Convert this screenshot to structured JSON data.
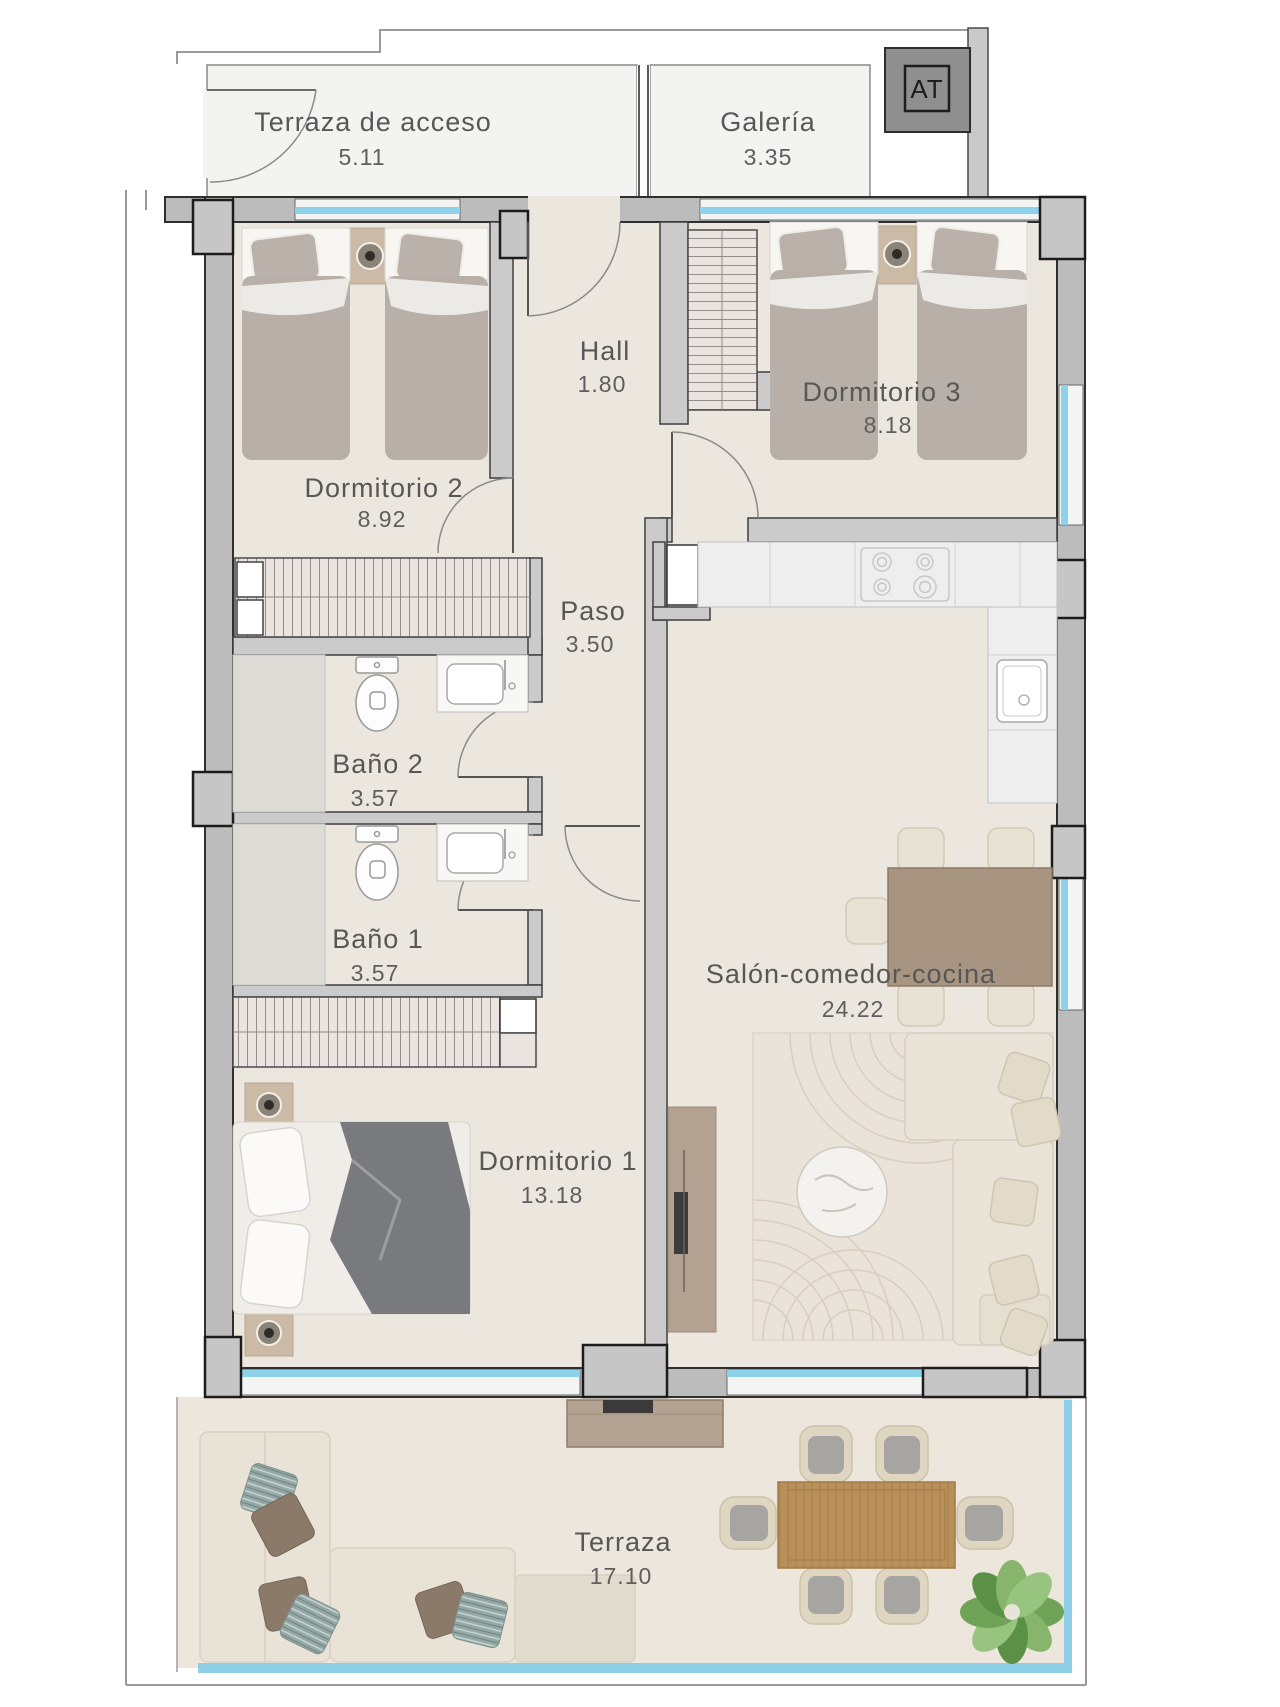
{
  "plan_type": "apartment floor plan",
  "rooms": {
    "terraza_acceso": {
      "name": "Terraza de acceso",
      "area": "5.11"
    },
    "galeria": {
      "name": "Galería",
      "area": "3.35"
    },
    "hall": {
      "name": "Hall",
      "area": "1.80"
    },
    "dormitorio_2": {
      "name": "Dormitorio 2",
      "area": "8.92"
    },
    "dormitorio_3": {
      "name": "Dormitorio 3",
      "area": "8.18"
    },
    "paso": {
      "name": "Paso",
      "area": "3.50"
    },
    "bano_2": {
      "name": "Baño 2",
      "area": "3.57"
    },
    "bano_1": {
      "name": "Baño 1",
      "area": "3.57"
    },
    "dormitorio_1": {
      "name": "Dormitorio 1",
      "area": "13.18"
    },
    "salon": {
      "name": "Salón-comedor-cocina",
      "area": "24.22"
    },
    "terraza": {
      "name": "Terraza",
      "area": "17.10"
    }
  },
  "shaft": {
    "label": "AT"
  },
  "colors": {
    "wall_fill": "#bcbcbc",
    "wall_edge": "#2f2f2f",
    "partition_fill": "#cbcbcb",
    "column_fill": "#c6c6c6",
    "floor": "#ece7de",
    "service_floor": "#f3f3f2",
    "window_glass": "#8ed1ea",
    "shower_tray": "#dcdbd6",
    "wood_table": "#b9905c",
    "sideboard": "#b3a291",
    "bed_duvet": "#b7afa8",
    "sofa": "#e9e3d7",
    "rug": "#eae3d9",
    "plant": "#6fa357",
    "label_text": "#575757",
    "shaft_fill": "#8f8f8f"
  }
}
